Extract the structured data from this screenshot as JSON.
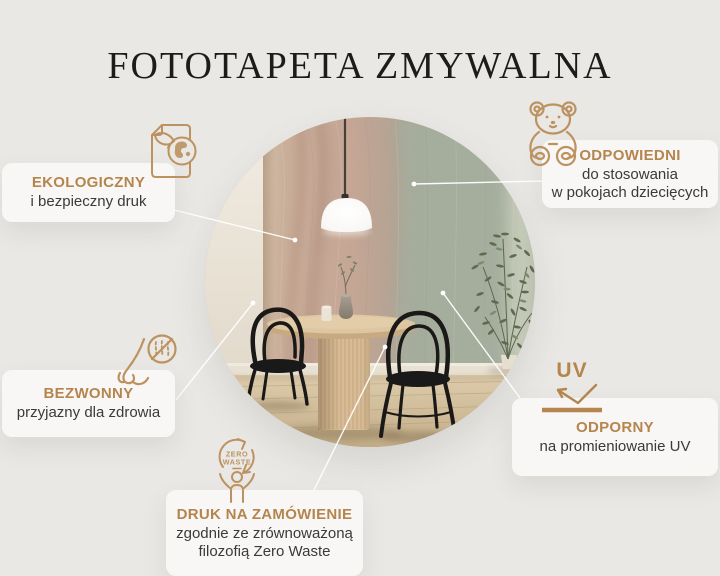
{
  "title": "FOTOTAPETA ZMYWALNA",
  "colors": {
    "background": "#e9e8e5",
    "card": "#f4f3f1",
    "accent": "#b5854e",
    "icon_stroke": "#bd9261",
    "body_text": "#3a3a3a",
    "callout_line": "#ffffff"
  },
  "features": {
    "eco": {
      "heading": "EKOLOGICZNY",
      "line1": "i bezpieczny druk",
      "icon": "document-leaf-globe-icon"
    },
    "kids": {
      "heading": "ODPOWIEDNI",
      "line1": "do stosowania",
      "line2": "w pokojach dziecięcych",
      "icon": "teddy-bear-icon"
    },
    "odorless": {
      "heading": "BEZWONNY",
      "line1": "przyjazny dla zdrowia",
      "icon": "nose-no-smell-icon"
    },
    "uv": {
      "heading": "ODPORNY",
      "line1": "na promieniowanie UV",
      "icon": "uv-reflection-icon",
      "icon_label": "UV"
    },
    "zero_waste": {
      "heading": "DRUK NA ZAMÓWIENIE",
      "line1": "zgodnie ze zrównoważoną",
      "line2": "filozofią Zero Waste",
      "icon": "zero-waste-icon",
      "icon_label_line1": "ZERO",
      "icon_label_line2": "WASTE"
    }
  }
}
